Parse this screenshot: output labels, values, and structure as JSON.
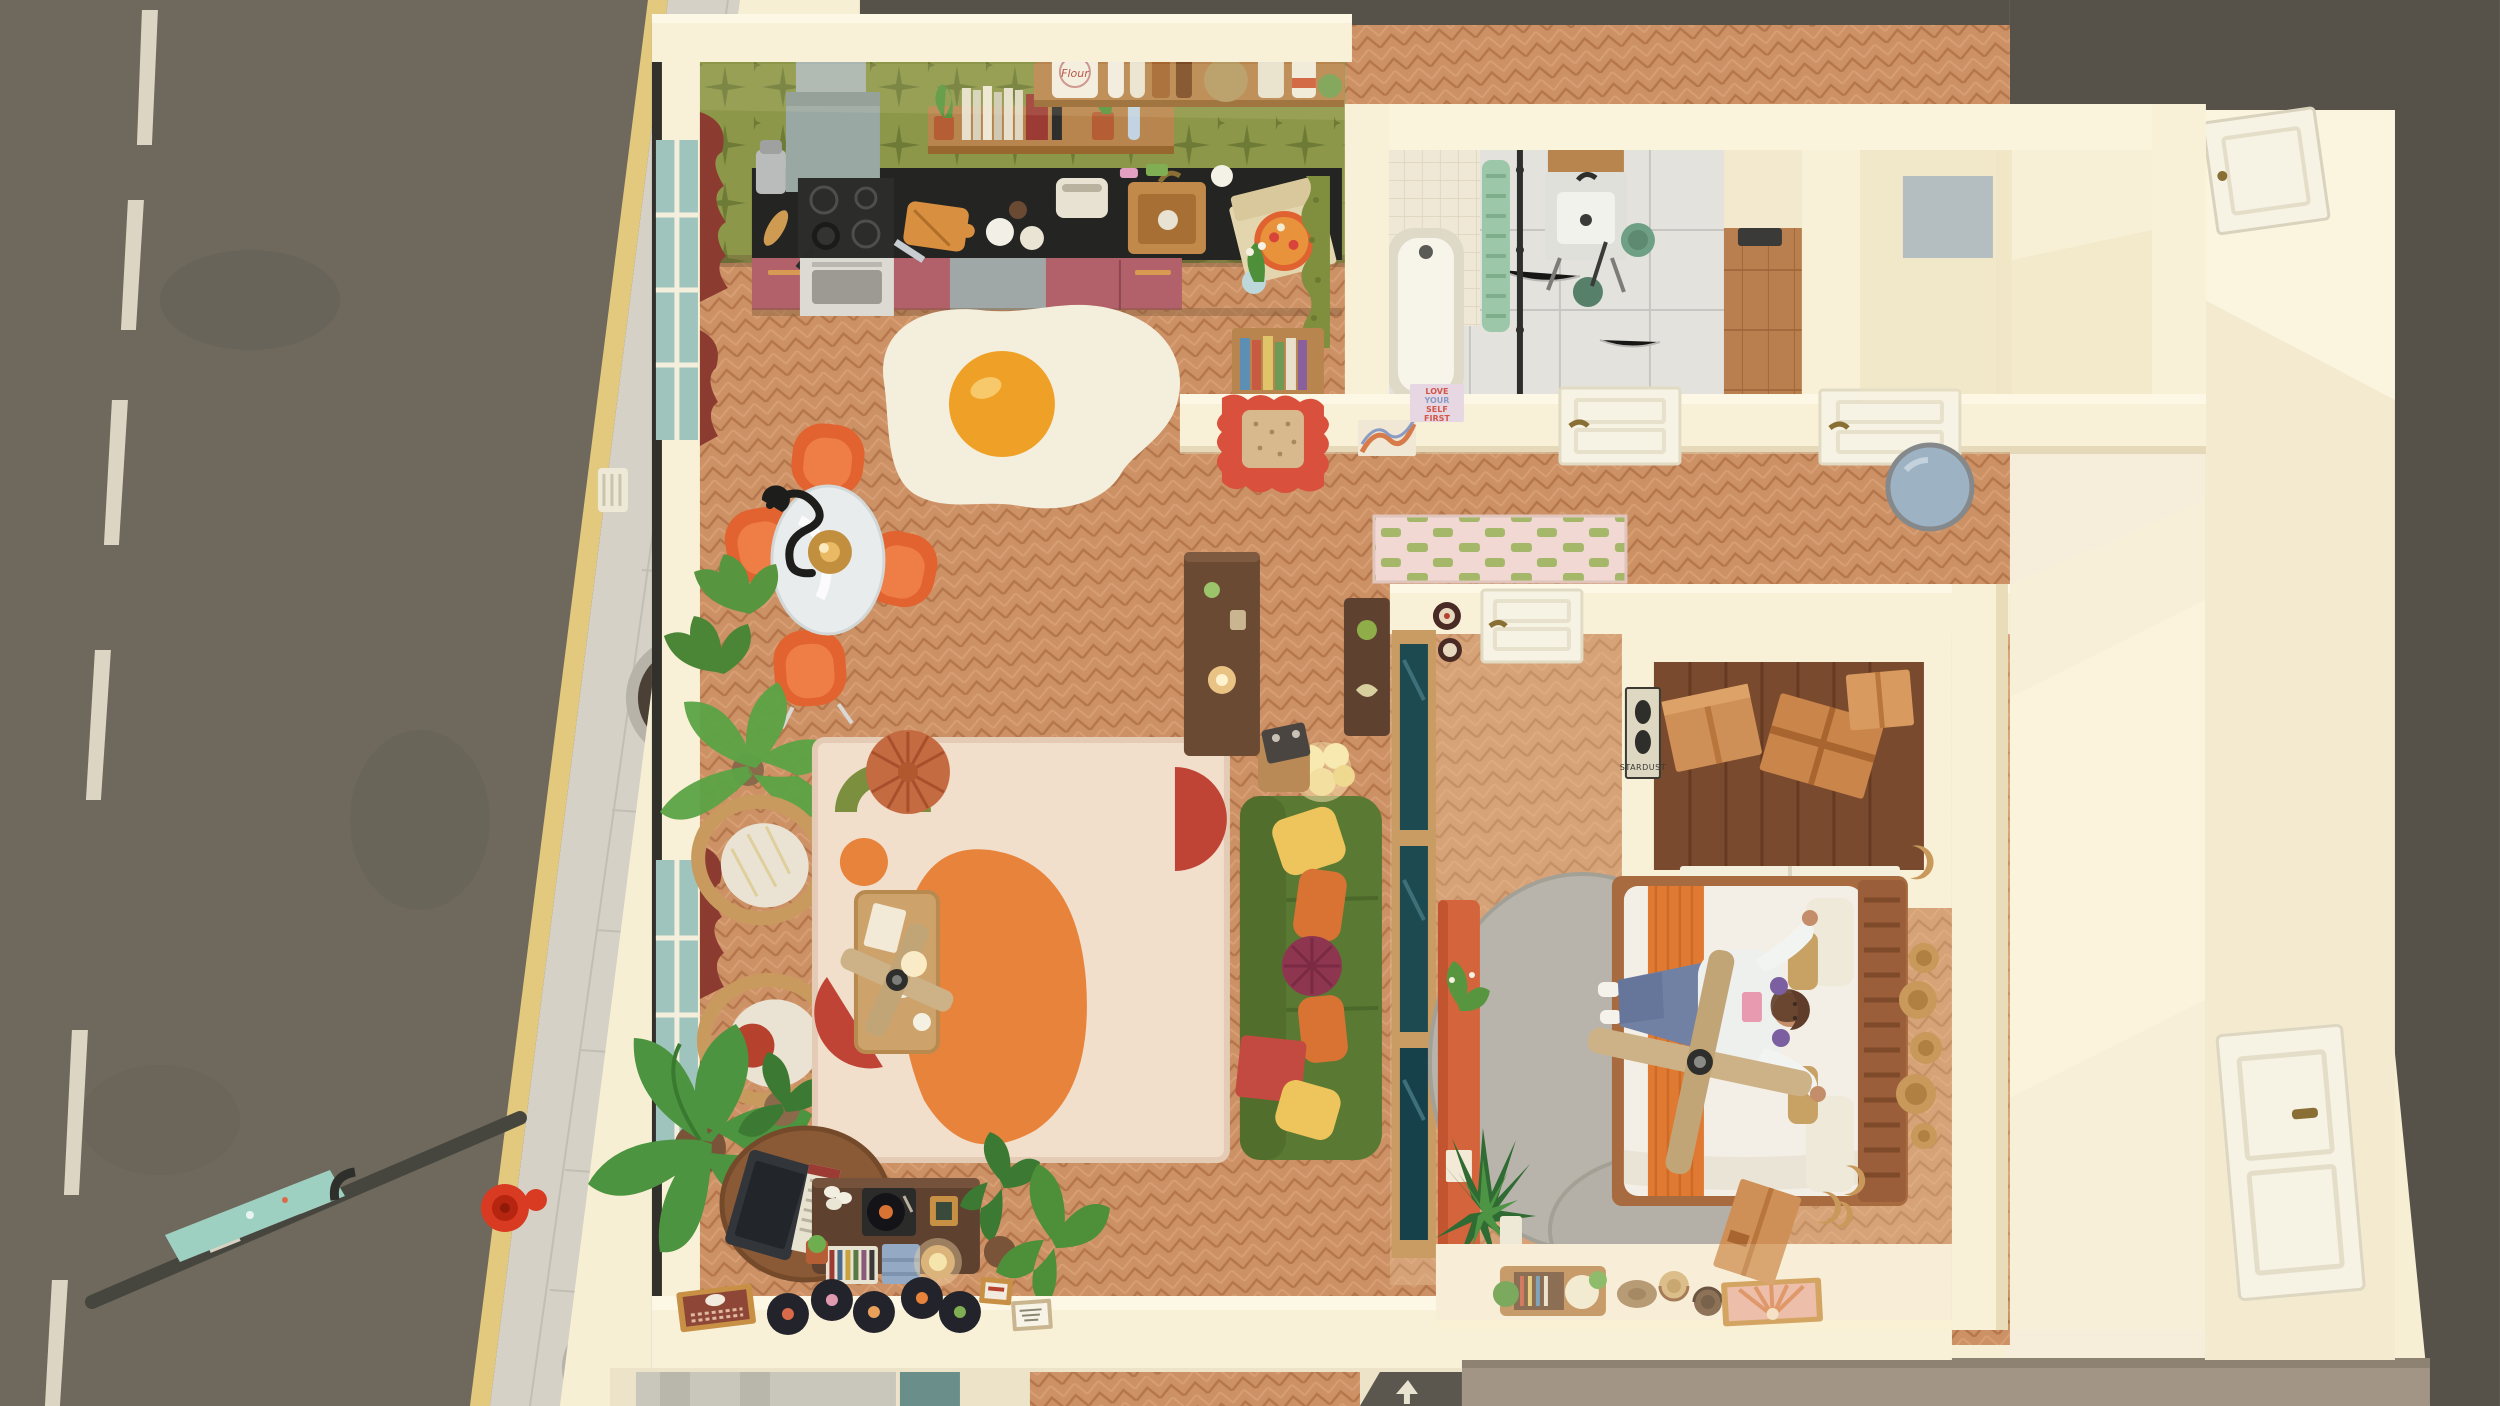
{
  "texts": {
    "flour_label": "Flour",
    "love_poster_lines": [
      "LOVE",
      "YOUR",
      "SELF",
      "FIRST"
    ],
    "stardust_poster": "STARDUST"
  },
  "palette": {
    "road": "#6e695c",
    "lane_dash": "#ddd5c3",
    "curb_yellow": "#e3c97e",
    "sidewalk": "#d5d1c7",
    "planter_soil": "#4a4035",
    "tree_leaves": "#e7b63b",
    "hydrant_red": "#d93a22",
    "banner_teal": "#9ed0c2",
    "roof_dark": "#56524a",
    "roof_tan": "#a39585",
    "wall_cream": "#f7efd4",
    "wall_lit": "#fdf8e6",
    "floor_wood": "#cd9166",
    "bedroom_wood": "#dca97d",
    "wallpaper_green": "#8d9749",
    "counter_black": "#242422",
    "cabinet_rose": "#b2606a",
    "shelf_wood": "#b9854f",
    "sink_copper": "#c18a4a",
    "egg_white": "#f4efdd",
    "egg_yolk": "#efa127",
    "chair_orange": "#e2632f",
    "curtain_red": "#8c3b31",
    "rattan": "#c99a5e",
    "rug_cream": "#f1decb",
    "rug_orange": "#e8833b",
    "rug_red": "#c04436",
    "rug_green": "#7c8f3f",
    "pouf_terracotta": "#c56b42",
    "sofa_green": "#5a7a33",
    "pillow_yellow": "#eec45c",
    "pillow_orange": "#d87334",
    "pillow_maroon": "#8e3550",
    "console_walnut": "#5f4130",
    "marble": "#e4e2dd",
    "shower_tile": "#efe8d6",
    "radiator_mint": "#9cc7a8",
    "bath_green": "#6f9f85",
    "runner_pink": "#f2d8d2",
    "runner_green": "#a5b86a",
    "door_white": "#f6f2e4",
    "mirror_red_frame": "#d9503d",
    "round_mirror_blue": "#9db3c4",
    "poster_pink_bg": "#e7d7e2",
    "poster_pink_text": "#d2574a",
    "cardboard_box": "#cf9057",
    "duvet_white": "#f4efe6",
    "bed_blanket_orange": "#e07a33",
    "headboard_wood": "#9a5f3a",
    "skin": "#c58e6a",
    "hair_brown": "#5f3d2a",
    "jeans_blue": "#7181a4",
    "gray_rug": "#b8b4ab",
    "bench_orange": "#d4643c",
    "glass_teal": "#9fc4bd",
    "partition_glass": "#1d4a50"
  },
  "scene": {
    "street": {
      "items": [
        "road",
        "lane dashes",
        "yellow curb line",
        "paved sidewalk",
        "tree planters",
        "yellow autumn trees",
        "fire hydrant",
        "street lamp with teal banner"
      ]
    },
    "kitchen": {
      "items": [
        "green star wallpaper",
        "range hood",
        "stove and oven",
        "black counter",
        "copper sink",
        "rose cabinets",
        "dishwasher",
        "wood shelves",
        "flour bag",
        "books",
        "pizza box",
        "cutting board",
        "toaster",
        "green doorway curtain",
        "bookshelf"
      ]
    },
    "dining": {
      "items": [
        "fried egg rug",
        "round glass table",
        "four orange chairs",
        "black squiggle pendant lamp"
      ]
    },
    "living_room": {
      "items": [
        "red curtained windows",
        "fern",
        "palm plant",
        "two rattan chairs",
        "banana plant",
        "abstract area rug",
        "terracotta pouf",
        "wood coffee table",
        "ceiling fan",
        "green sofa with pillows",
        "globe floor lamp",
        "radio side table",
        "walnut media console",
        "record player",
        "leaning tv",
        "vinyl records",
        "houseplants",
        "tall cabinet",
        "cat print",
        "framed notes"
      ]
    },
    "hallway": {
      "items": [
        "red wavy mirror",
        "swirl art",
        "love yourself poster",
        "two white doors",
        "round blue mirror",
        "pink green checker runner"
      ]
    },
    "bathroom": {
      "items": [
        "white tile shower",
        "bathtub",
        "mint radiator",
        "shower rod",
        "marble floor",
        "marble sink vanity",
        "wood mirror cabinet",
        "green bin",
        "green stool",
        "storage niches"
      ]
    },
    "bedroom": {
      "items": [
        "glass partition",
        "orange bench with plant",
        "gray round rugs",
        "bed with orange blanket",
        "person lying on bed",
        "wood ceiling fan",
        "slat headboard",
        "rattan wall baskets",
        "closet with cardboard boxes",
        "stardust poster",
        "entry door with plates",
        "agave plant",
        "storage bench",
        "three hats",
        "sunburst art",
        "leaning box"
      ]
    },
    "exterior_right": {
      "items": [
        "dark rooftops",
        "sunlit corridor",
        "two white corridor doors"
      ]
    }
  }
}
